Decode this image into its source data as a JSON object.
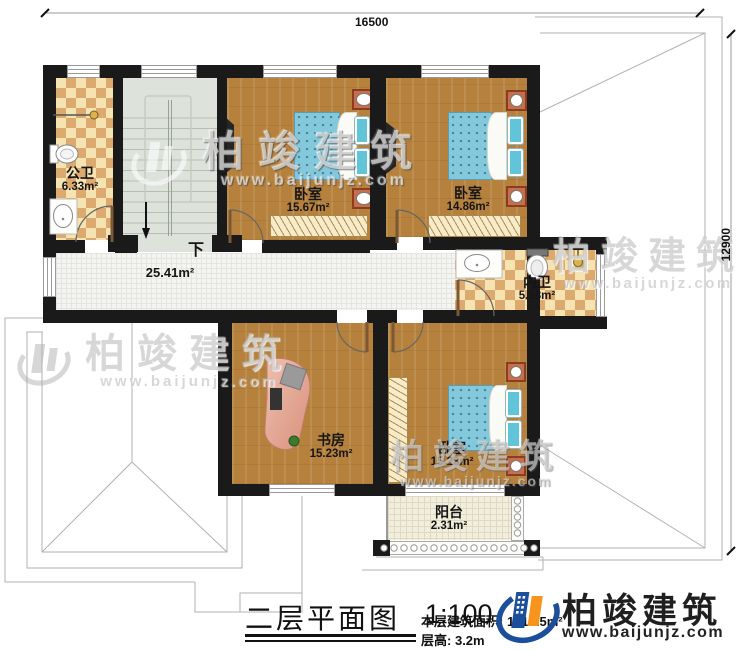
{
  "dimensions": {
    "top": "16500",
    "right": "12900"
  },
  "rooms": [
    {
      "id": "public-bath",
      "name": "公卫",
      "area": "6.33m²"
    },
    {
      "id": "bedroom-1",
      "name": "卧室",
      "area": "15.67m²"
    },
    {
      "id": "bedroom-2",
      "name": "卧室",
      "area": "14.86m²"
    },
    {
      "id": "ensuite-bath",
      "name": "内卫",
      "area": "5.58m²"
    },
    {
      "id": "hallway",
      "name": "",
      "area": "25.41m²"
    },
    {
      "id": "study",
      "name": "书房",
      "area": "15.23m²"
    },
    {
      "id": "bedroom-3",
      "name": "卧室",
      "area": "15.23m²"
    },
    {
      "id": "balcony",
      "name": "阳台",
      "area": "2.31m²"
    }
  ],
  "stairs": {
    "down_label": "下"
  },
  "titleblock": {
    "title": "二层平面图",
    "scale": "1:100",
    "area_label": "本层建筑面积:",
    "area_value": "121.25m²",
    "height_label": "层高:",
    "height_value": "3.2m"
  },
  "brand": {
    "name": "柏竣建筑",
    "url": "www.baijunjz.com"
  },
  "watermark": {
    "name": "柏竣建筑",
    "url": "www.baijunjz.com"
  },
  "colors": {
    "wall": "#1a1a1a",
    "wood_floor": "#b5813c",
    "tile_tan": "#dca96f",
    "tile_cream": "#f6e3b2",
    "stair": "#dde2da",
    "bed_blue": "#84c8dc",
    "brand_blue": "#1b4e9b",
    "brand_orange": "#f7941e"
  }
}
